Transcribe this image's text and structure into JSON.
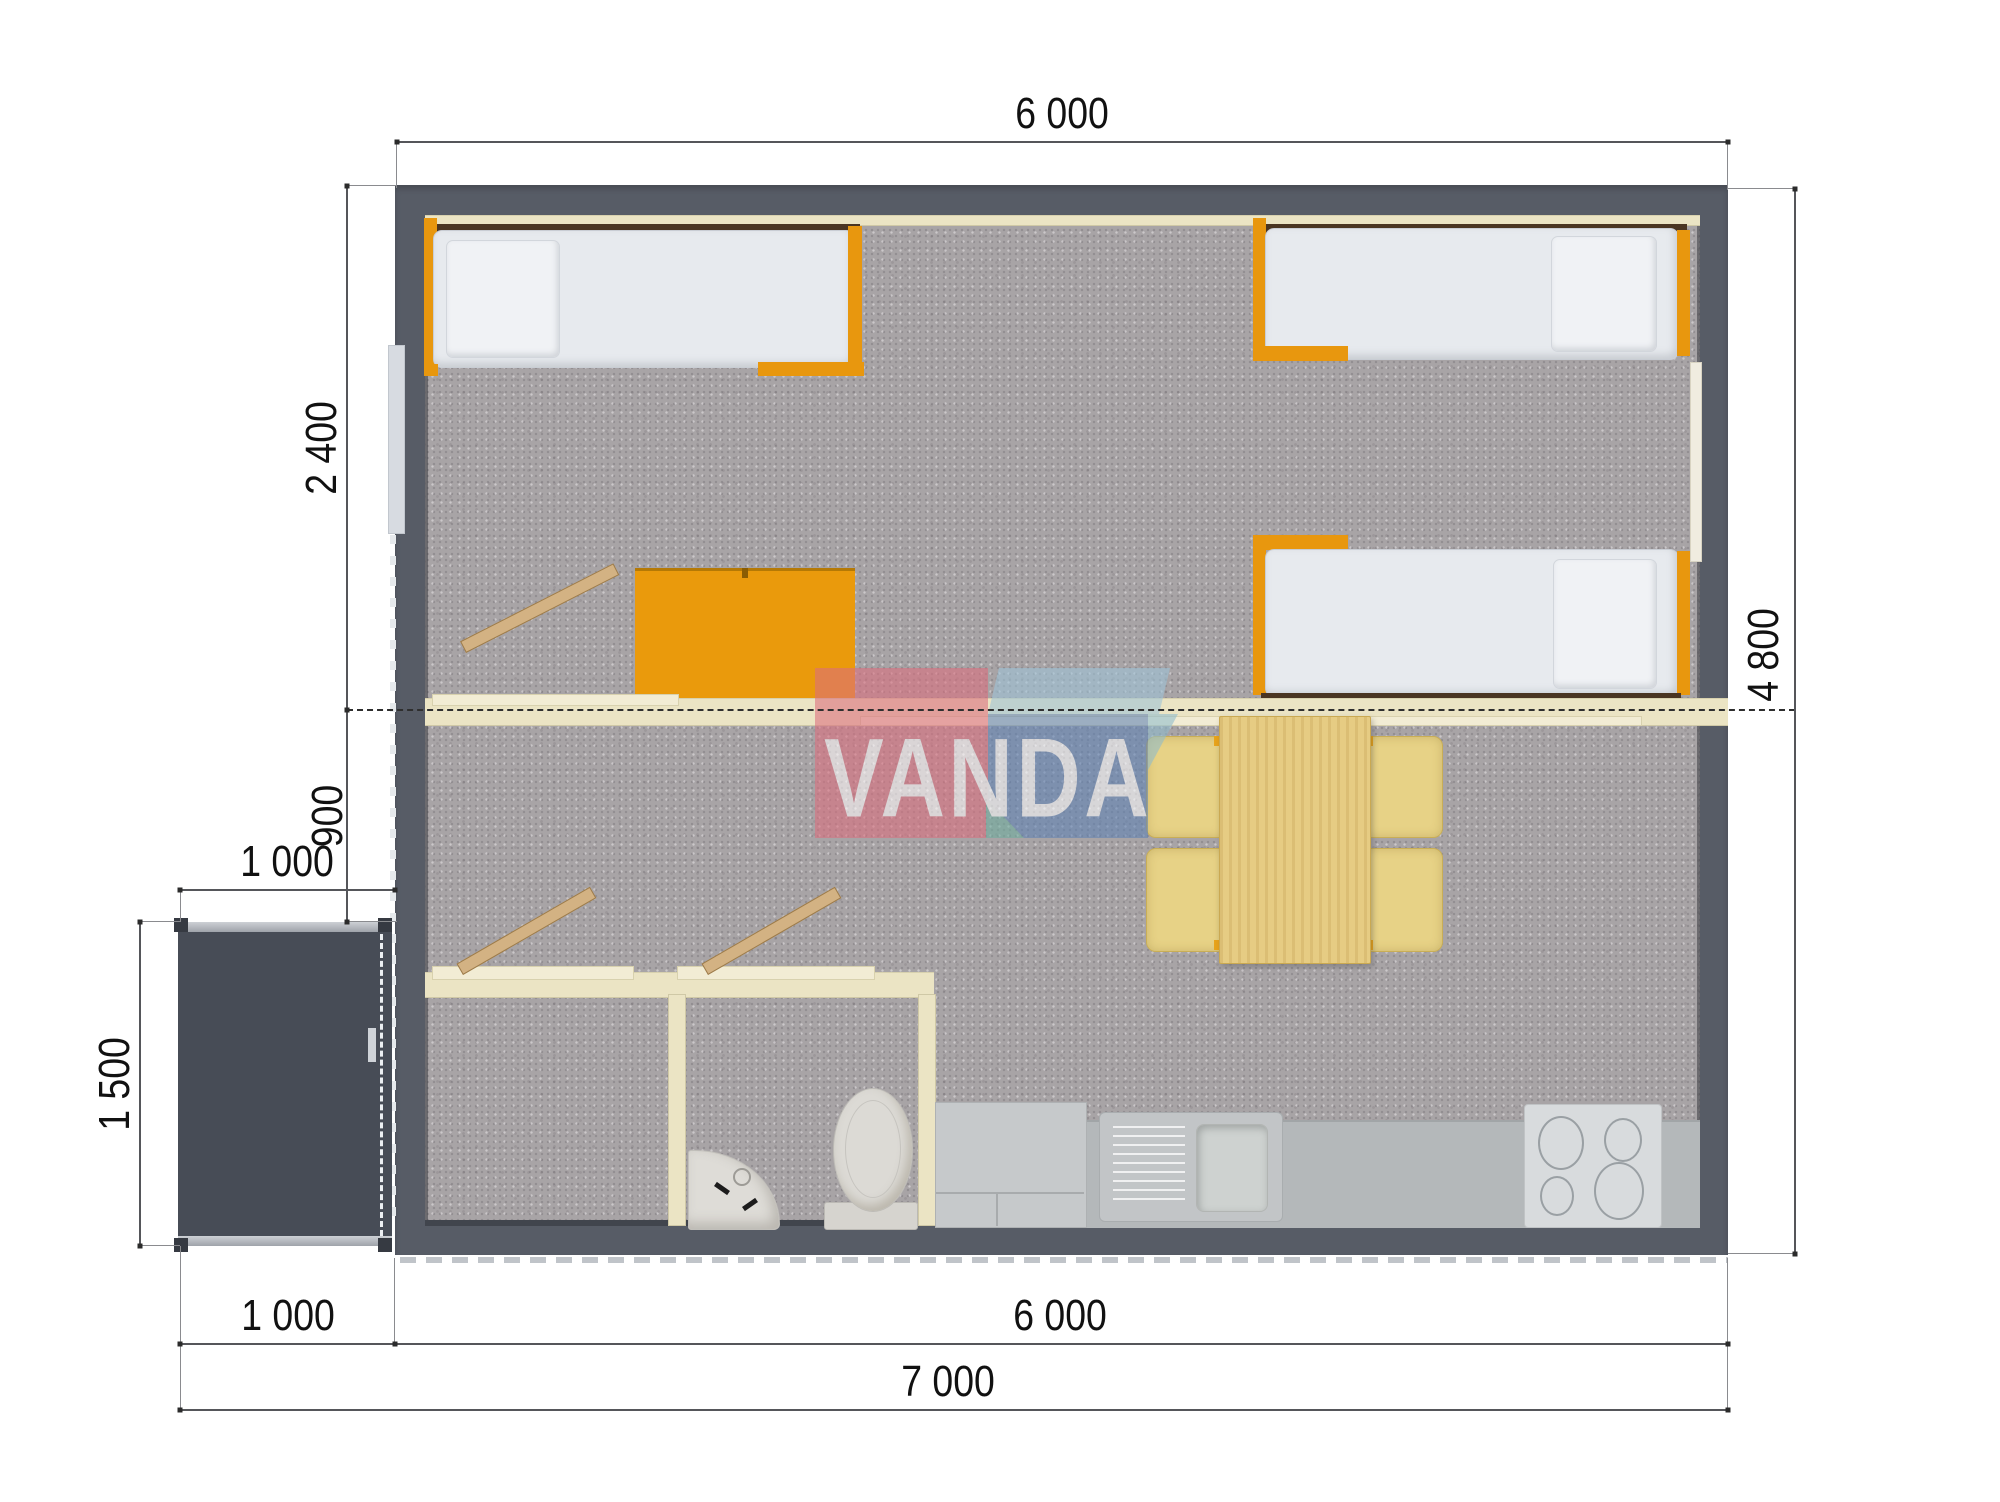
{
  "watermark": {
    "text": "VANDA"
  },
  "dimensions": {
    "top_width": "6 000",
    "bedroom_depth": "2 400",
    "hall_depth": "900",
    "porch_width": "1 000",
    "porch_depth": "1 500",
    "house_depth": "4 800",
    "porch_width_bottom": "1 000",
    "house_width_bottom": "6 000",
    "total_width": "7 000"
  },
  "colors": {
    "wall": "#575c66",
    "porch": "#474c56",
    "floor_carpet": "#a8a4a6",
    "partition": "#ebe4c4",
    "accent_orange": "#e8970e",
    "wood": "#e6cc83",
    "kitchen_counter": "#b4b8ba",
    "watermark_pink": "#dc6e7e",
    "watermark_blue": "#5f82b4",
    "watermark_lid": "#9fc4d8"
  }
}
